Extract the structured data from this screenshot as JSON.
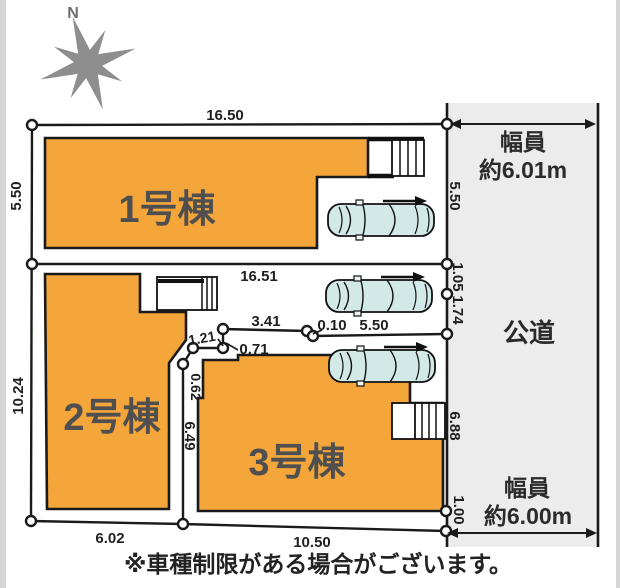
{
  "compass": {
    "north_label": "N"
  },
  "buildings": [
    {
      "label": "1号棟"
    },
    {
      "label": "2号棟"
    },
    {
      "label": "3号棟"
    }
  ],
  "dimensions": {
    "top_width": "16.50",
    "divider_width": "16.51",
    "left_upper": "5.50",
    "left_lower": "10.24",
    "bottom_left": "6.02",
    "bottom_right": "10.50",
    "mid_a": "3.41",
    "mid_b": "0.10",
    "mid_c": "5.50",
    "jag_up": "0.71",
    "jag_across": "1.21",
    "jag_down": "0.62",
    "lot_side": "6.49",
    "road_side_a": "5.50",
    "road_side_b": "1.05",
    "road_side_c": "1.74",
    "road_side_d": "6.88",
    "road_side_e": "1.00"
  },
  "road": {
    "name": "公道",
    "top_width_line1": "幅員",
    "top_width_line2": "約6.01m",
    "bottom_width_line1": "幅員",
    "bottom_width_line2": "約6.00m"
  },
  "note": {
    "text": "※車種制限がある場合がございます。"
  },
  "colors": {
    "building": "#F5A63B",
    "road": "#ececec",
    "car": "#d2e9e7",
    "line": "#1a1a1a",
    "edge_strip": "#d6d6d6",
    "compass": "#8e8e8e"
  }
}
